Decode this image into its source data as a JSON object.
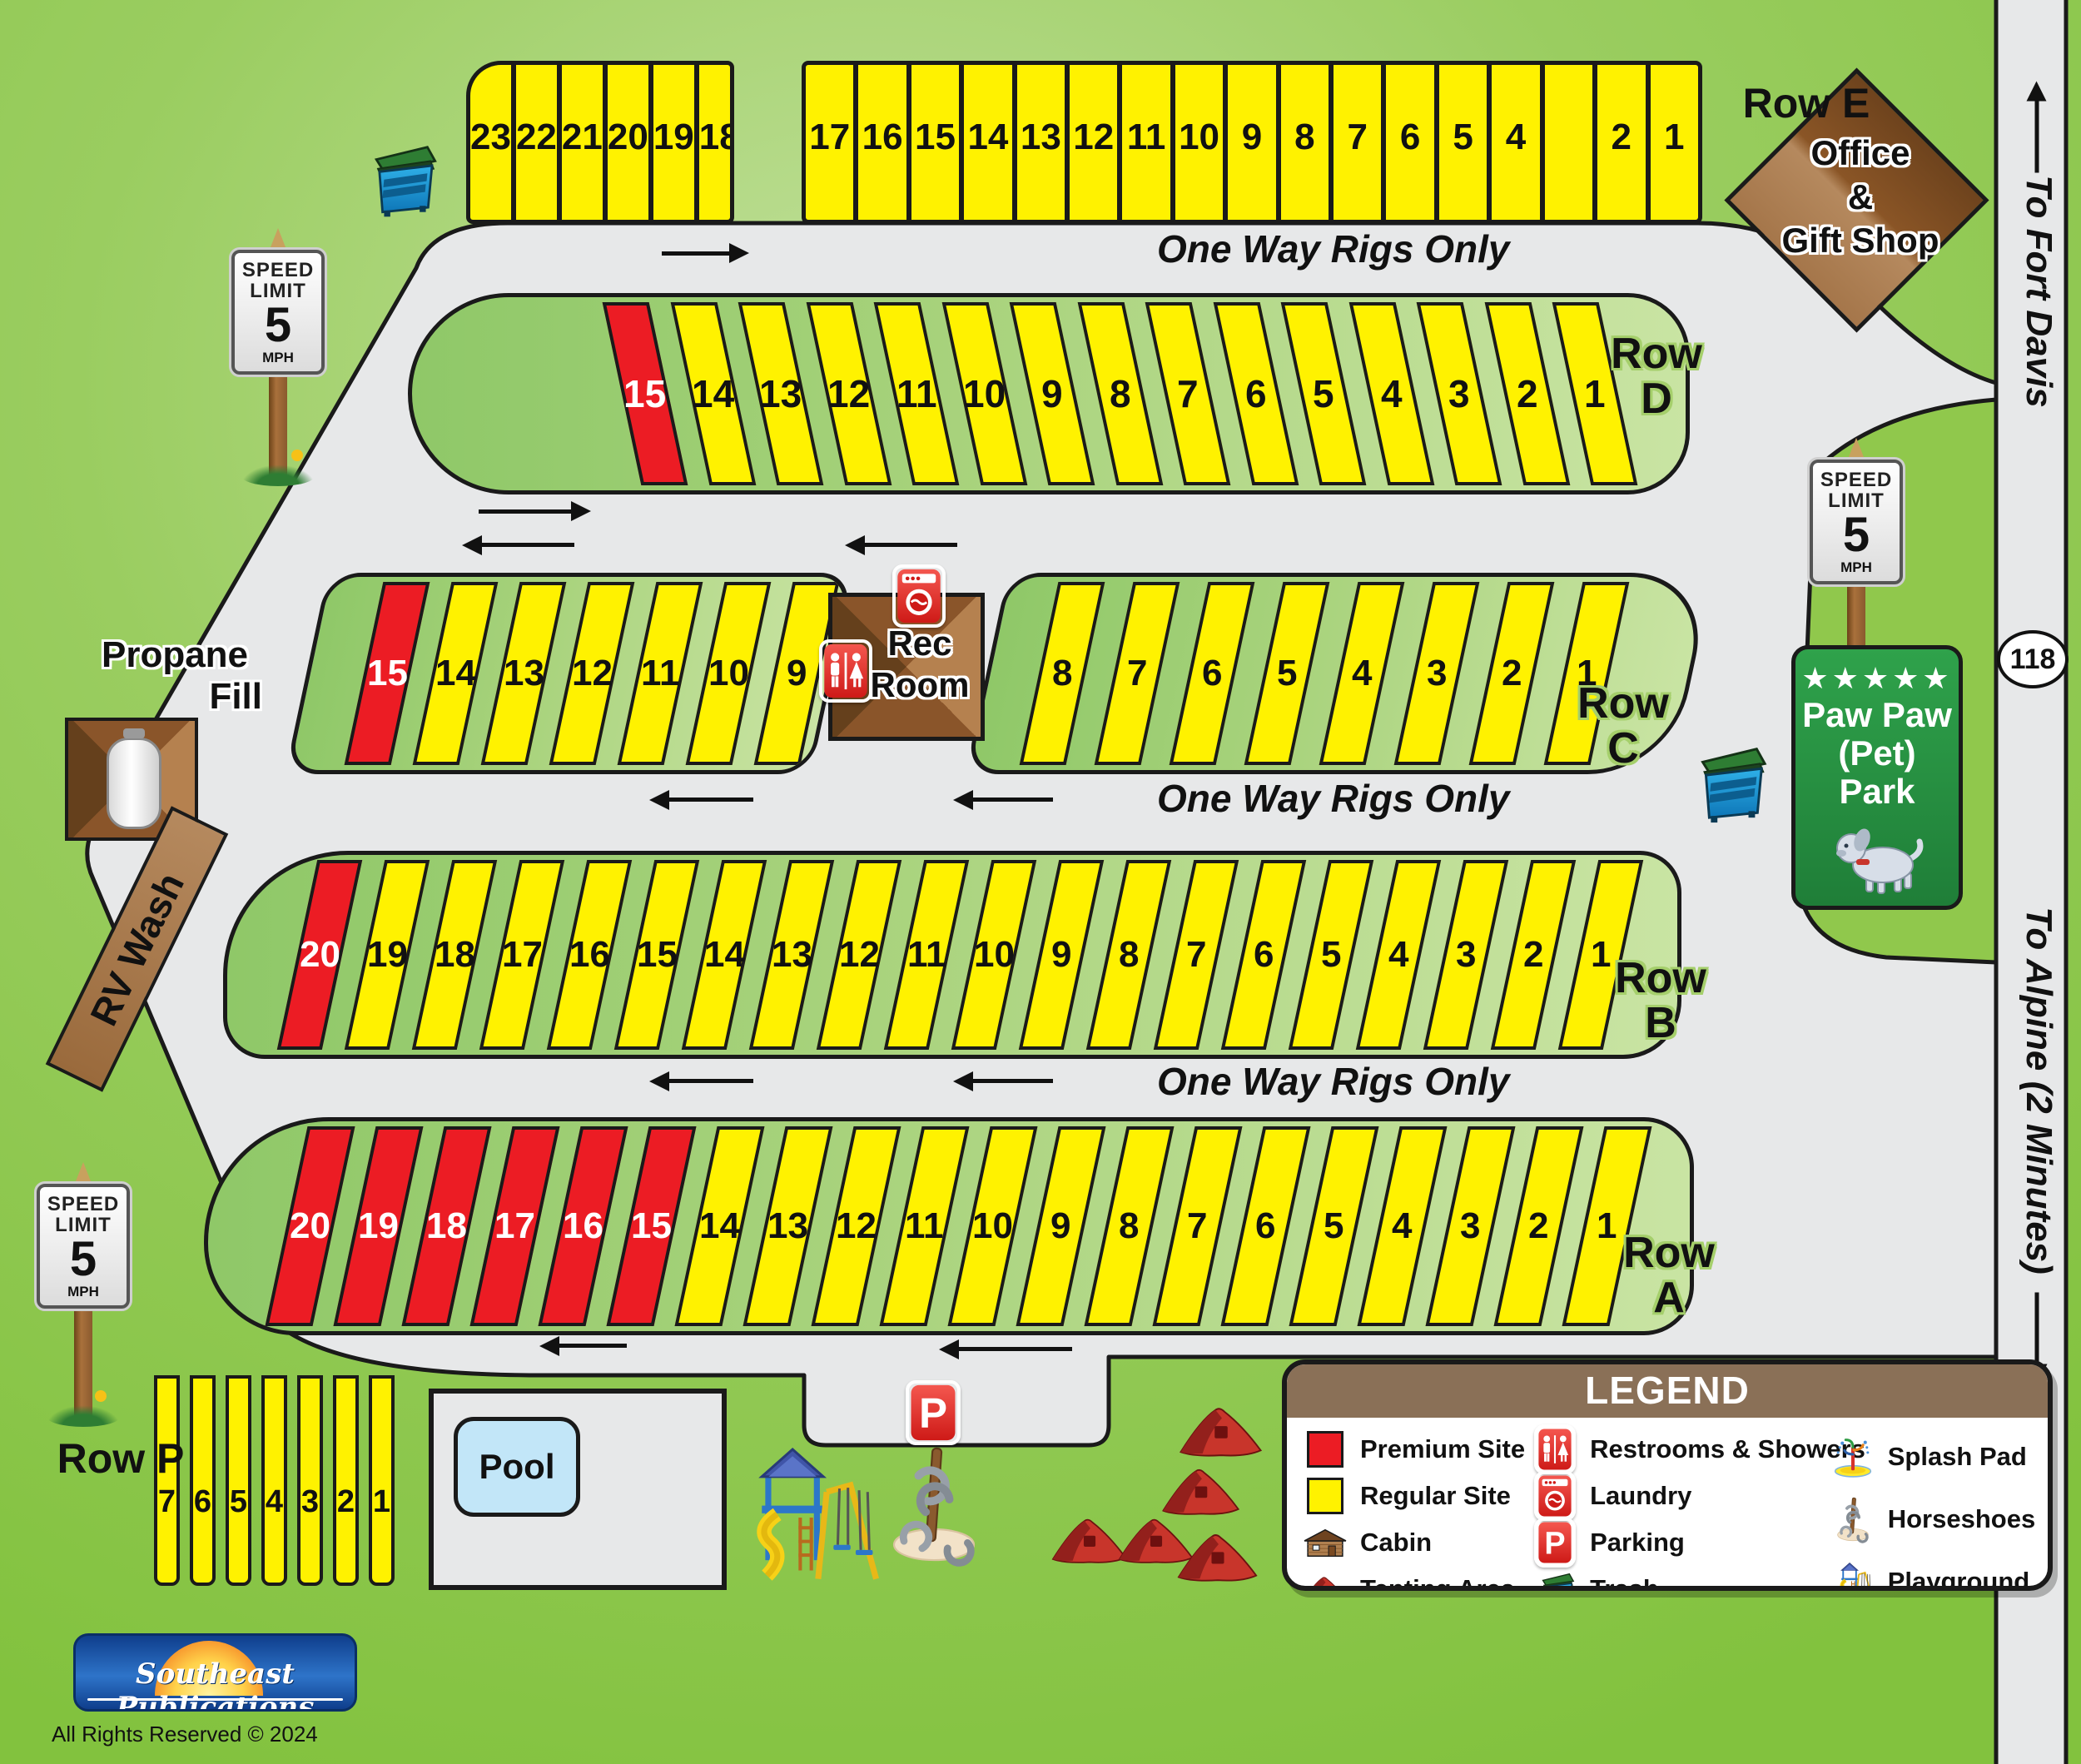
{
  "map": {
    "one_way_label": "One Way Rigs Only",
    "row_labels": {
      "E": "Row E",
      "P": "Row P"
    },
    "row_labels_split": {
      "D": [
        "Row",
        "D"
      ],
      "C": [
        "Row",
        "C"
      ],
      "B": [
        "Row",
        "B"
      ],
      "A": [
        "Row",
        "A"
      ]
    },
    "roads": {
      "to_fort_davis": "To Fort Davis",
      "to_alpine": "To Alpine (2 Minutes)",
      "highway_badge": "118"
    },
    "speed_sign": {
      "line1": "SPEED",
      "line2": "LIMIT",
      "value": "5",
      "unit": "MPH"
    },
    "colors": {
      "premium": "#EC1C24",
      "regular": "#FFF200",
      "road": "#E7E8E9",
      "band_green": "#9ACD60",
      "pet_park_green": "#28913F"
    }
  },
  "site_rows": {
    "E_left": [
      {
        "n": "23"
      },
      {
        "n": "22"
      },
      {
        "n": "21"
      },
      {
        "n": "20"
      },
      {
        "n": "19"
      },
      {
        "n": "18"
      }
    ],
    "E_right": [
      {
        "n": "17"
      },
      {
        "n": "16"
      },
      {
        "n": "15"
      },
      {
        "n": "14"
      },
      {
        "n": "13"
      },
      {
        "n": "12"
      },
      {
        "n": "11"
      },
      {
        "n": "10"
      },
      {
        "n": "9"
      },
      {
        "n": "8"
      },
      {
        "n": "7"
      },
      {
        "n": "6"
      },
      {
        "n": "5"
      },
      {
        "n": "4"
      },
      {
        "n": ""
      },
      {
        "n": "2"
      },
      {
        "n": "1"
      }
    ],
    "D": [
      {
        "n": "15",
        "premium": true
      },
      {
        "n": "14"
      },
      {
        "n": "13"
      },
      {
        "n": "12"
      },
      {
        "n": "11"
      },
      {
        "n": "10"
      },
      {
        "n": "9"
      },
      {
        "n": "8"
      },
      {
        "n": "7"
      },
      {
        "n": "6"
      },
      {
        "n": "5"
      },
      {
        "n": "4"
      },
      {
        "n": "3"
      },
      {
        "n": "2"
      },
      {
        "n": "1"
      }
    ],
    "C_left": [
      {
        "n": "15",
        "premium": true
      },
      {
        "n": "14"
      },
      {
        "n": "13"
      },
      {
        "n": "12"
      },
      {
        "n": "11"
      },
      {
        "n": "10"
      },
      {
        "n": "9"
      }
    ],
    "C_right": [
      {
        "n": "8"
      },
      {
        "n": "7"
      },
      {
        "n": "6"
      },
      {
        "n": "5"
      },
      {
        "n": "4"
      },
      {
        "n": "3"
      },
      {
        "n": "2"
      },
      {
        "n": "1"
      }
    ],
    "B": [
      {
        "n": "20",
        "premium": true
      },
      {
        "n": "19"
      },
      {
        "n": "18"
      },
      {
        "n": "17"
      },
      {
        "n": "16"
      },
      {
        "n": "15"
      },
      {
        "n": "14"
      },
      {
        "n": "13"
      },
      {
        "n": "12"
      },
      {
        "n": "11"
      },
      {
        "n": "10"
      },
      {
        "n": "9"
      },
      {
        "n": "8"
      },
      {
        "n": "7"
      },
      {
        "n": "6"
      },
      {
        "n": "5"
      },
      {
        "n": "4"
      },
      {
        "n": "3"
      },
      {
        "n": "2"
      },
      {
        "n": "1"
      }
    ],
    "A": [
      {
        "n": "20",
        "premium": true
      },
      {
        "n": "19",
        "premium": true
      },
      {
        "n": "18",
        "premium": true
      },
      {
        "n": "17",
        "premium": true
      },
      {
        "n": "16",
        "premium": true
      },
      {
        "n": "15",
        "premium": true
      },
      {
        "n": "14"
      },
      {
        "n": "13"
      },
      {
        "n": "12"
      },
      {
        "n": "11"
      },
      {
        "n": "10"
      },
      {
        "n": "9"
      },
      {
        "n": "8"
      },
      {
        "n": "7"
      },
      {
        "n": "6"
      },
      {
        "n": "5"
      },
      {
        "n": "4"
      },
      {
        "n": "3"
      },
      {
        "n": "2"
      },
      {
        "n": "1"
      }
    ],
    "P": [
      {
        "n": "7"
      },
      {
        "n": "6"
      },
      {
        "n": "5"
      },
      {
        "n": "4"
      },
      {
        "n": "3"
      },
      {
        "n": "2"
      },
      {
        "n": "1"
      }
    ]
  },
  "facilities": {
    "office": {
      "line1": "Office",
      "line2": "&",
      "line3": "Gift Shop"
    },
    "rec_room": {
      "line1": "Rec",
      "line2": "Room"
    },
    "propane": {
      "line1": "Propane",
      "line2": "Fill"
    },
    "rv_wash": "RV Wash",
    "pool": "Pool",
    "pet_park": {
      "stars": "★★★★★",
      "line1": "Paw Paw",
      "line2": "(Pet) Park"
    }
  },
  "legend": {
    "title": "LEGEND",
    "columns": [
      [
        {
          "icon": "premium-swatch",
          "label": "Premium Site"
        },
        {
          "icon": "regular-swatch",
          "label": "Regular Site"
        },
        {
          "icon": "cabin",
          "label": "Cabin"
        },
        {
          "icon": "tent",
          "label": "Tenting Area"
        }
      ],
      [
        {
          "icon": "restrooms",
          "label": "Restrooms & Showers"
        },
        {
          "icon": "laundry",
          "label": "Laundry"
        },
        {
          "icon": "parking",
          "label": "Parking"
        },
        {
          "icon": "trash",
          "label": "Trash"
        }
      ],
      [
        {
          "icon": "splash-pad",
          "label": "Splash Pad"
        },
        {
          "icon": "horseshoes",
          "label": "Horseshoes"
        },
        {
          "icon": "playground",
          "label": "Playground"
        }
      ]
    ]
  },
  "footer": {
    "publisher": "Southeast Publications",
    "rights": "All Rights Reserved © 2024"
  }
}
